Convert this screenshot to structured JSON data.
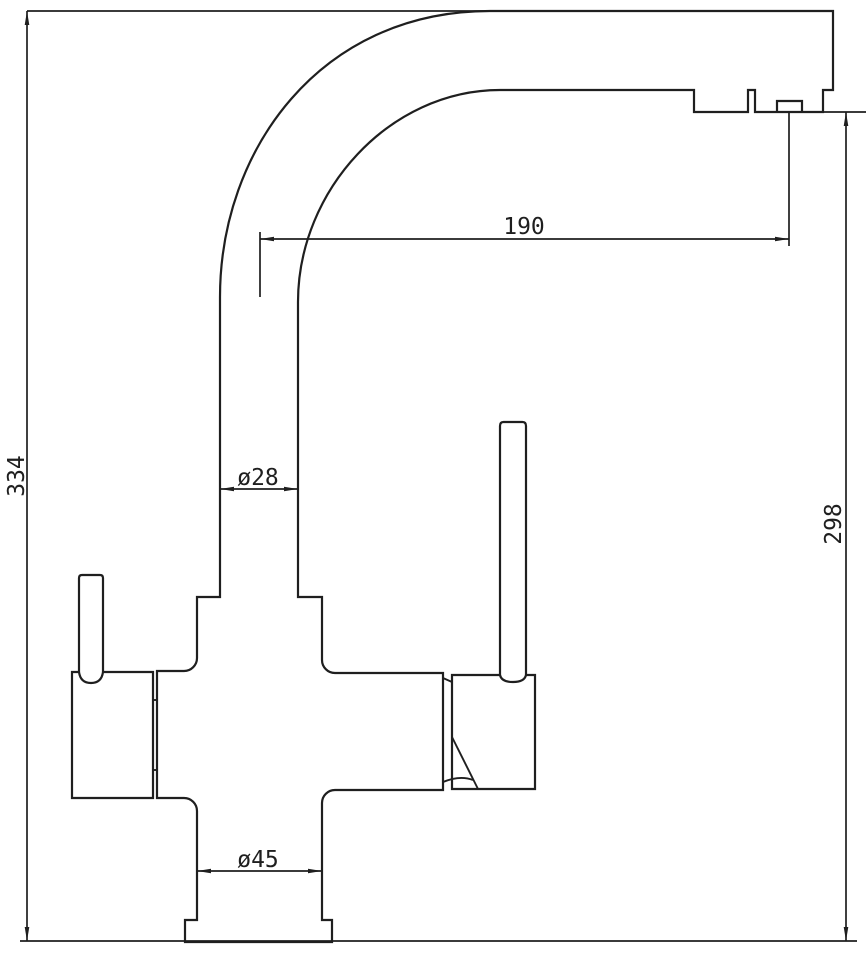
{
  "drawing": {
    "title": "kitchen faucet technical side-view drawing",
    "type": "dimensioned line drawing",
    "colors": {
      "line": "#1f1f1f",
      "background": "#ffffff"
    },
    "dimensions": {
      "overall_height": "334",
      "outlet_height": "298",
      "spout_reach": "190",
      "column_diameter": "ø28",
      "base_diameter": "ø45"
    }
  }
}
